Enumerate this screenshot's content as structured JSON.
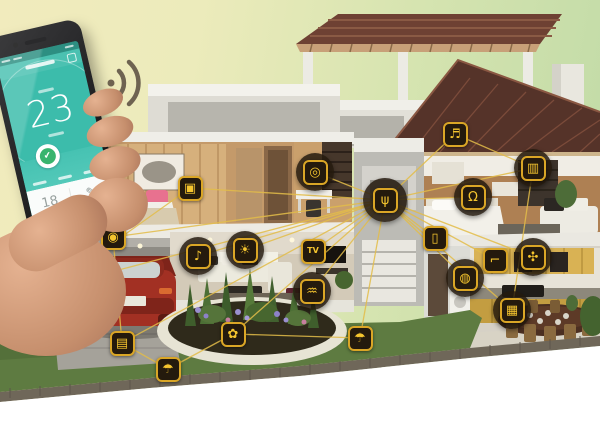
{
  "scene": {
    "description": "Smart home concept: cutaway house with connected smart-device icons linked to a central hub, and a hand holding a smartphone thermostat app"
  },
  "phone": {
    "temperature": "23",
    "shield_check": "✔",
    "preset_value": "18",
    "edit_glyph": "✎"
  },
  "colors": {
    "accent_gold": "#e3bd49",
    "line": "#e3bd49",
    "node_bg": "#241a0d",
    "node_border": "#daa626",
    "glyph": "#f5c52f",
    "phone_teal": "#3cbcab",
    "shield_green": "#39b46e"
  },
  "devices": [
    {
      "id": "garage-camera",
      "name": "garage-camera-icon",
      "glyph": "◉",
      "x": 113,
      "y": 237,
      "circled": false
    },
    {
      "id": "ev-plug",
      "name": "charging-plug-icon",
      "glyph": "⚡",
      "x": 50,
      "y": 288,
      "circled": false
    },
    {
      "id": "garage-door",
      "name": "garage-door-icon",
      "glyph": "▤",
      "x": 122,
      "y": 343,
      "circled": false
    },
    {
      "id": "sprinkler-left",
      "name": "lawn-sprinkler-icon",
      "glyph": "☂",
      "x": 168,
      "y": 369,
      "circled": false
    },
    {
      "id": "garden-irrigation",
      "name": "garden-irrigation-icon",
      "glyph": "✿",
      "x": 233,
      "y": 334,
      "circled": false
    },
    {
      "id": "sprinkler-right",
      "name": "lawn-sprinkler-icon",
      "glyph": "☂",
      "x": 360,
      "y": 338,
      "circled": false
    },
    {
      "id": "living-audio",
      "name": "audio-player-icon",
      "glyph": "♪",
      "x": 198,
      "y": 256,
      "circled": true
    },
    {
      "id": "light",
      "name": "smart-light-icon",
      "glyph": "☀",
      "x": 245,
      "y": 250,
      "circled": true
    },
    {
      "id": "tv",
      "name": "smart-tv-icon",
      "glyph": "TV",
      "x": 313,
      "y": 251,
      "circled": false
    },
    {
      "id": "wifi-node",
      "name": "wifi-icon",
      "glyph": "♒",
      "x": 312,
      "y": 291,
      "circled": true
    },
    {
      "id": "bedroom-camera",
      "name": "bedroom-camera-icon",
      "glyph": "▣",
      "x": 190,
      "y": 188,
      "circled": false
    },
    {
      "id": "study-device",
      "name": "study-camera-icon",
      "glyph": "◎",
      "x": 315,
      "y": 172,
      "circled": true
    },
    {
      "id": "hub",
      "name": "smart-hub-icon",
      "glyph": "ψ",
      "x": 385,
      "y": 200,
      "circled": true,
      "size": 44
    },
    {
      "id": "wall-switch",
      "name": "wall-switch-icon",
      "glyph": "▯",
      "x": 435,
      "y": 238,
      "circled": false
    },
    {
      "id": "doorbell",
      "name": "doorbell-icon",
      "glyph": "♬",
      "x": 455,
      "y": 134,
      "circled": false
    },
    {
      "id": "curtain",
      "name": "smart-curtain-icon",
      "glyph": "▥",
      "x": 533,
      "y": 168,
      "circled": true
    },
    {
      "id": "headset",
      "name": "headset-icon",
      "glyph": "Ω",
      "x": 473,
      "y": 197,
      "circled": true
    },
    {
      "id": "exhaust-fan",
      "name": "exhaust-fan-icon",
      "glyph": "✣",
      "x": 533,
      "y": 257,
      "circled": true
    },
    {
      "id": "faucet",
      "name": "water-faucet-icon",
      "glyph": "⌐",
      "x": 495,
      "y": 260,
      "circled": false
    },
    {
      "id": "washer",
      "name": "washing-machine-icon",
      "glyph": "◍",
      "x": 465,
      "y": 278,
      "circled": true
    },
    {
      "id": "stove",
      "name": "kitchen-stove-icon",
      "glyph": "▦",
      "x": 512,
      "y": 310,
      "circled": true
    }
  ],
  "links": [
    [
      "hub",
      "study-device"
    ],
    [
      "hub",
      "bedroom-camera"
    ],
    [
      "hub",
      "living-audio"
    ],
    [
      "hub",
      "light"
    ],
    [
      "hub",
      "tv"
    ],
    [
      "hub",
      "wifi-node"
    ],
    [
      "hub",
      "wall-switch"
    ],
    [
      "hub",
      "doorbell"
    ],
    [
      "hub",
      "curtain"
    ],
    [
      "hub",
      "headset"
    ],
    [
      "hub",
      "exhaust-fan"
    ],
    [
      "hub",
      "washer"
    ],
    [
      "hub",
      "faucet"
    ],
    [
      "hub",
      "stove"
    ],
    [
      "hub",
      "garage-camera"
    ],
    [
      "hub",
      "garage-door"
    ],
    [
      "hub",
      "garden-irrigation"
    ],
    [
      "hub",
      "sprinkler-right"
    ],
    [
      "hub",
      "ev-plug"
    ],
    [
      "garage-door",
      "sprinkler-left"
    ],
    [
      "sprinkler-left",
      "garden-irrigation"
    ],
    [
      "garden-irrigation",
      "sprinkler-right"
    ],
    [
      "bedroom-camera",
      "ev-plug"
    ],
    [
      "doorbell",
      "curtain"
    ],
    [
      "curtain",
      "stove"
    ],
    [
      "garage-camera",
      "garage-door"
    ]
  ]
}
